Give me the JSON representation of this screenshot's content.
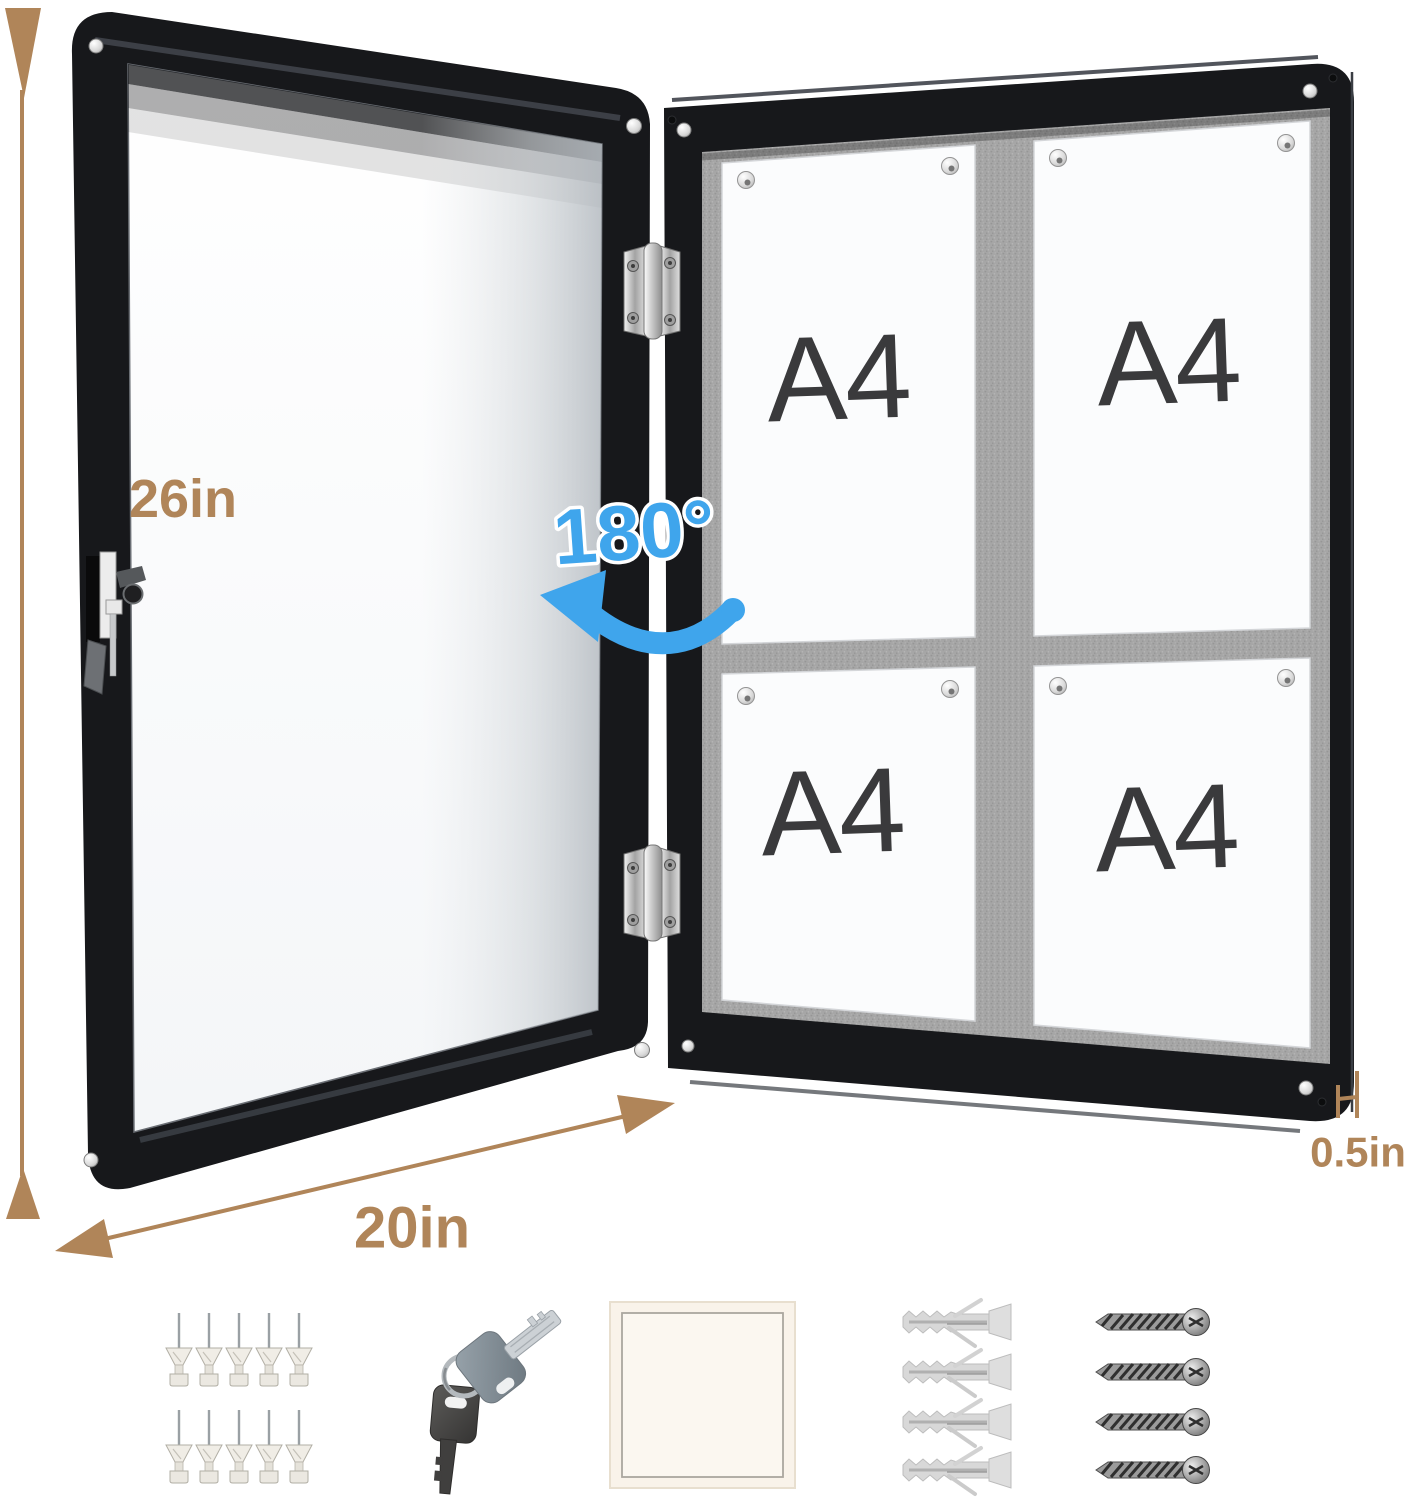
{
  "labels": {
    "height": "26in",
    "width": "20in",
    "depth": "0.5in",
    "rotation": "180°"
  },
  "board": {
    "papers": [
      {
        "label": "A4"
      },
      {
        "label": "A4"
      },
      {
        "label": "A4"
      },
      {
        "label": "A4"
      }
    ]
  },
  "accessories": {
    "push_pins": 10,
    "keys": 2,
    "notepads": 1,
    "wall_anchors": 4,
    "screws": 4
  },
  "colors": {
    "dimension": "#b08559",
    "rotation": "#3fa5ec",
    "frame": "#17181b",
    "felt": "#a6a6a6",
    "paper": "#fbfcfd",
    "a4_text": "#3a3a3c",
    "hardware": "#d9d9d9"
  }
}
